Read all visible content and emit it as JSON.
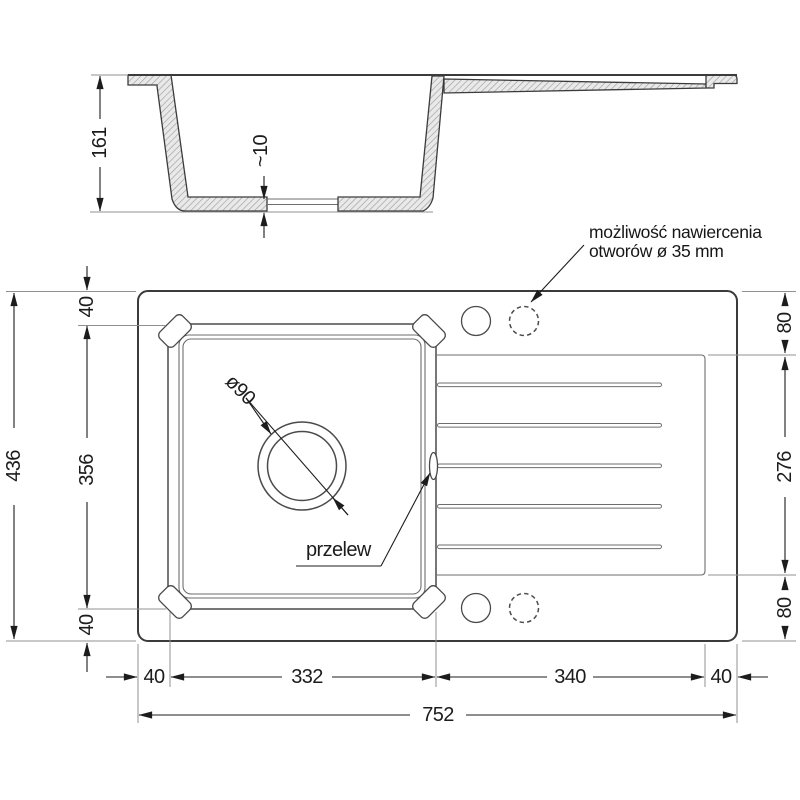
{
  "side_view": {
    "dims": {
      "height": "161",
      "bottom_thickness": "~10"
    }
  },
  "plan_view": {
    "dims": {
      "depth_total": "436",
      "margin_top": "40",
      "bowl_depth": "356",
      "margin_bottom": "40",
      "hole_offset_top": "80",
      "drainer_depth": "276",
      "hole_offset_bottom": "80",
      "margin_left": "40",
      "bowl_width": "332",
      "drainer_width": "340",
      "margin_right": "40",
      "width_total": "752",
      "drain_diameter": "ø90"
    },
    "annotations": {
      "overflow": "przelew",
      "drill_note_line1": "możliwość nawiercenia",
      "drill_note_line2": "otworów ø 35 mm"
    }
  },
  "colors": {
    "outline": "#3b3b3b",
    "dimension": "#1c1c1c",
    "extension": "#909090",
    "hatch_line": "#999999",
    "hatch_bg": "#e9e9e9",
    "background": "#ffffff"
  }
}
